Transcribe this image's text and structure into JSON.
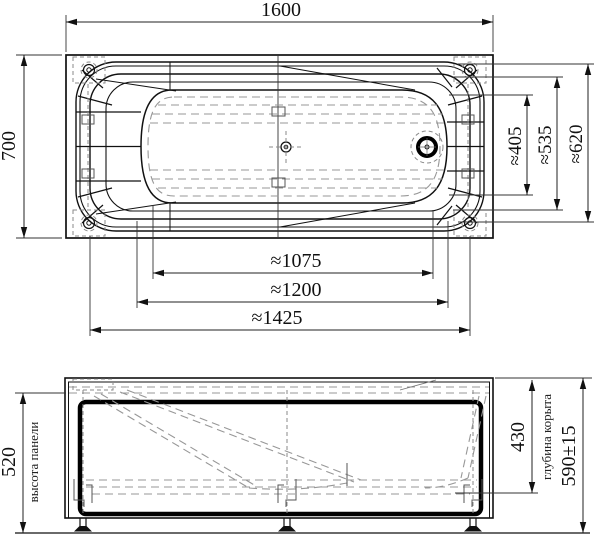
{
  "drawing": {
    "kind": "bathtub dimensional drawing",
    "views": [
      "plan",
      "front elevation"
    ]
  },
  "plan_view": {
    "length_overall": "1600",
    "width_overall": "700",
    "width_bowl_bottom": "≈405",
    "width_bowl_rim": "≈535",
    "width_shell": "≈620",
    "length_bowl_bottom": "≈1075",
    "length_bowl_rim": "≈1200",
    "length_mounting_span": "≈1425"
  },
  "front_view": {
    "panel_height": "520",
    "panel_height_caption": "высота панели",
    "bowl_depth": "430",
    "bowl_depth_caption": "глубина корыта",
    "overall_height": "590±15"
  },
  "colors": {
    "line": "#111111",
    "hidden_line": "#979797",
    "background": "#ffffff"
  }
}
